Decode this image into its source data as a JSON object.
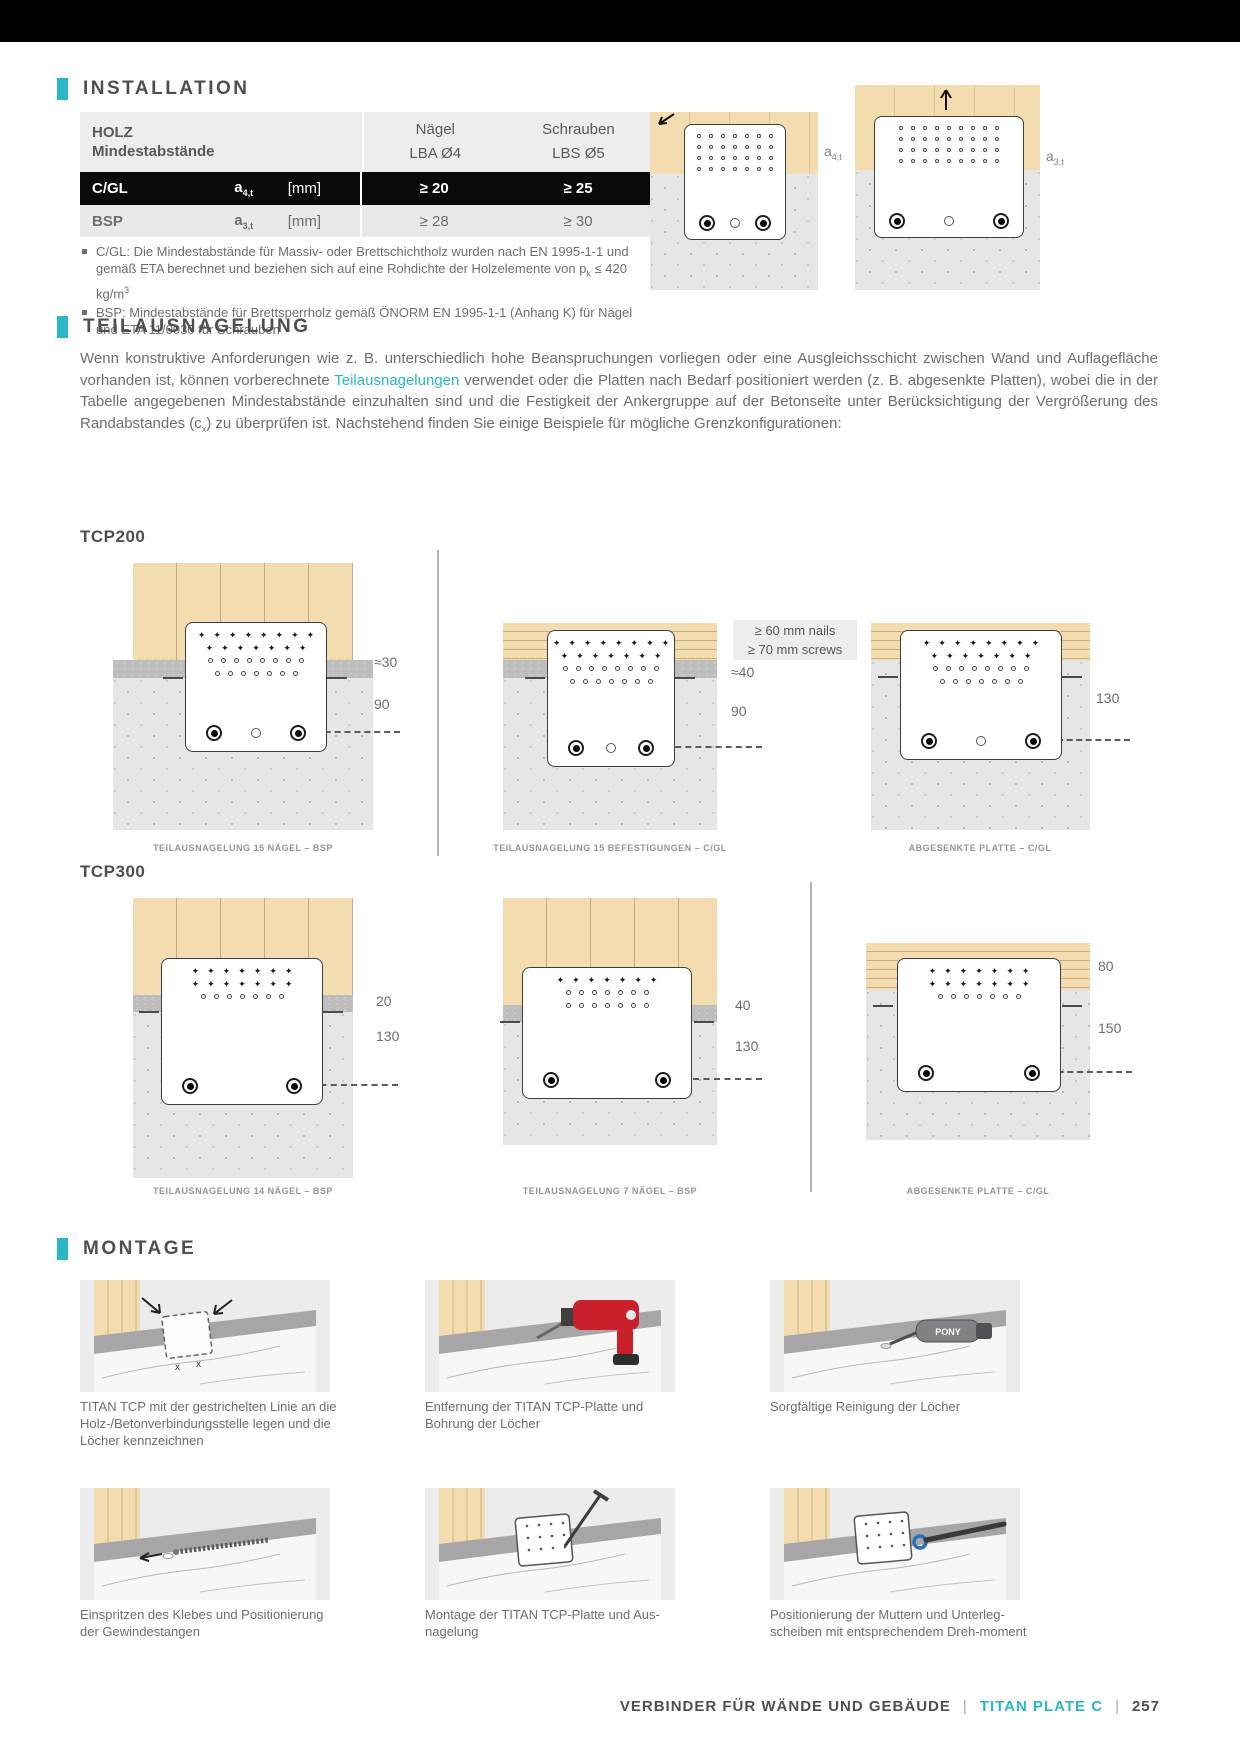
{
  "accent_color": "#2bb7c5",
  "installation": {
    "title": "INSTALLATION",
    "table": {
      "col_wood_line1": "HOLZ",
      "col_wood_line2": "Mindestabstände",
      "col_nails_line1": "Nägel",
      "col_nails_line2": "LBA Ø4",
      "col_screws_line1": "Schrauben",
      "col_screws_line2": "LBS Ø5",
      "rows": [
        {
          "material": "C/GL",
          "symbol_base": "a",
          "symbol_sub": "4,t",
          "unit": "[mm]",
          "nails": "≥ 20",
          "screws": "≥ 25"
        },
        {
          "material": "BSP",
          "symbol_base": "a",
          "symbol_sub": "3,t",
          "unit": "[mm]",
          "nails": "≥ 28",
          "screws": "≥ 30"
        }
      ]
    },
    "footnote1_segments": [
      {
        "t": "C/GL: Die Mindestabstände für Massiv- oder Brettschichtholz wurden nach EN 1995-1-1 und gemäß ETA berechnet und beziehen sich auf eine Rohdichte der Holzelemente von p"
      },
      {
        "t": "k",
        "s": "sub"
      },
      {
        "t": " ≤ 420 kg/m"
      },
      {
        "t": "3",
        "s": "sup"
      }
    ],
    "footnote2_segments": [
      {
        "t": "BSP: Mindestabstände für Brettsperrholz gemäß ÖNORM EN 1995-1-1 (Anhang K) für Nägel und ETA 11/0030 für Schrauben"
      }
    ],
    "diagram_labels": [
      {
        "base": "a",
        "sub": "4,t"
      },
      {
        "base": "a",
        "sub": "3,t"
      }
    ]
  },
  "teilausnagelung": {
    "title": "TEILAUSNAGELUNG",
    "paragraph_segments": [
      {
        "t": "Wenn konstruktive Anforderungen wie z. B. unterschiedlich hohe Beanspruchungen vorliegen oder eine Ausgleichsschicht zwischen Wand und Auflagefläche vorhanden ist, können vorberechnete "
      },
      {
        "t": "Teilausnagelungen",
        "s": "accent"
      },
      {
        "t": " verwendet oder die Platten nach Bedarf positioniert werden (z. B. abgesenkte Platten), wobei die in der Tabelle angegebenen Mindestabstände einzuhalten sind und die Festigkeit der Ankergruppe auf der Betonseite unter Berücksichtigung der Vergrößerung des Randabstandes (c"
      },
      {
        "t": "x",
        "s": "sub"
      },
      {
        "t": ") zu überprüfen ist. Nachstehend finden Sie einige Beispiele für mögliche Grenzkonfigurationen:"
      }
    ],
    "note_box_line1": "≥ 60 mm nails",
    "note_box_line2": "≥ 70 mm screws",
    "tcp200": {
      "label": "TCP200",
      "diagrams": [
        {
          "caption": "TEILAUSNAGELUNG 15 NÄGEL – BSP",
          "m1": "≈30",
          "m2": "90"
        },
        {
          "caption": "TEILAUSNAGELUNG 15 BEFESTIGUNGEN – C/GL",
          "m1": "≈40",
          "m2": "90"
        },
        {
          "caption": "ABGESENKTE PLATTE – C/GL",
          "m1": "130"
        }
      ]
    },
    "tcp300": {
      "label": "TCP300",
      "diagrams": [
        {
          "caption": "TEILAUSNAGELUNG 14 NÄGEL – BSP",
          "m1": "20",
          "m2": "130"
        },
        {
          "caption": "TEILAUSNAGELUNG 7 NÄGEL – BSP",
          "m1": "40",
          "m2": "130"
        },
        {
          "caption": "ABGESENKTE PLATTE – C/GL",
          "m1": "80",
          "m2": "150"
        }
      ]
    }
  },
  "montage": {
    "title": "MONTAGE",
    "pony_label": "PONY",
    "x_mark": "x",
    "steps": [
      "TITAN TCP mit der gestrichelten Linie an die Holz-/Betonverbindungsstelle legen und die Löcher kennzeichnen",
      "Entfernung der TITAN TCP-Platte und Bohrung der Löcher",
      "Sorgfältige Reinigung der Löcher",
      "Einspritzen des Klebes und Positionierung der Gewindestangen",
      "Montage der TITAN TCP-Platte und Aus-nagelung",
      "Positionierung der Muttern und Unterleg-scheiben mit entsprechendem Dreh-moment"
    ]
  },
  "footer": {
    "section": "VERBINDER FÜR WÄNDE UND GEBÄUDE",
    "separator": "|",
    "product": "TITAN PLATE C",
    "page": "257"
  }
}
